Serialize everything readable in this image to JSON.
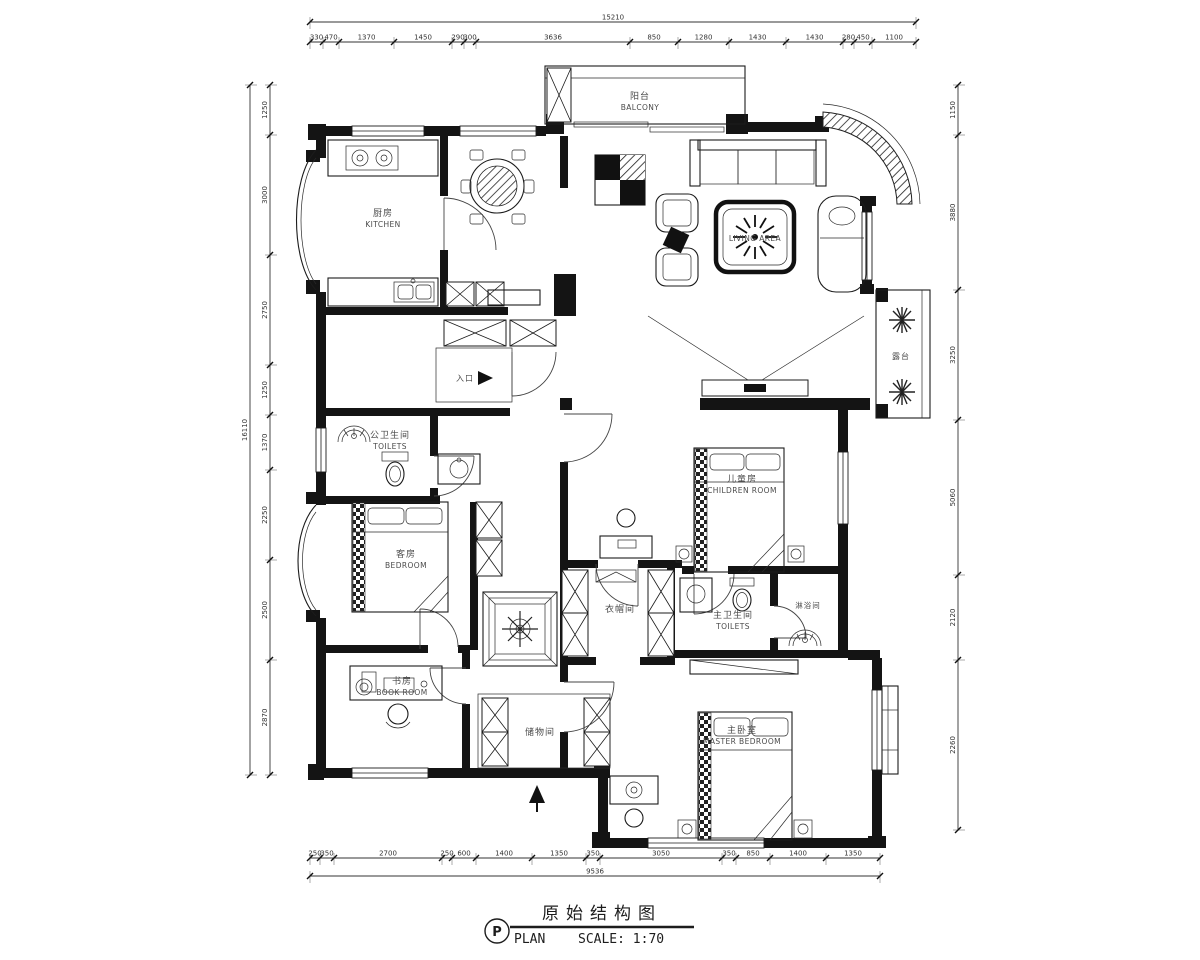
{
  "title_block": {
    "symbol": "P",
    "drawing_title": "原始结构图",
    "plan_label": "PLAN",
    "scale_label": "SCALE: 1:70"
  },
  "rooms": {
    "kitchen": {
      "cn": "厨房",
      "en": "KITCHEN"
    },
    "balcony": {
      "cn": "阳台",
      "en": "BALCONY"
    },
    "living": {
      "en": "LIVING AREA"
    },
    "children": {
      "cn": "儿童房",
      "en": "CHILDREN ROOM"
    },
    "guest": {
      "cn": "客房",
      "en": "BEDROOM"
    },
    "master": {
      "cn": "主卧室",
      "en": "MASTER BEDROOM"
    },
    "public_toilet": {
      "cn": "公卫生间",
      "en": "TOILETS"
    },
    "master_toilet": {
      "cn": "主卫生间",
      "en": "TOILETS"
    },
    "shower": {
      "cn": "淋浴间"
    },
    "closet": {
      "cn": "衣帽间"
    },
    "storage": {
      "cn": "储物间"
    },
    "study": {
      "cn": "书房",
      "en": "BOOK ROOM"
    },
    "entry": {
      "cn": "入口"
    },
    "terrace": {
      "cn": "露台"
    }
  },
  "dimensions": {
    "top": {
      "total": "15210",
      "segments": [
        "330",
        "470",
        "1370",
        "1450",
        "290",
        "300",
        "3636",
        "850",
        "1280",
        "1430",
        "1430",
        "280",
        "450",
        "1100"
      ]
    },
    "bottom": {
      "total": "9536",
      "segments": [
        "250",
        "350",
        "2700",
        "250",
        "600",
        "1400",
        "1350",
        "350",
        "3050",
        "350",
        "850",
        "1400",
        "1350"
      ]
    },
    "left": {
      "total": "16110",
      "segments": [
        "1250",
        "3000",
        "2750",
        "1250",
        "1370",
        "2250",
        "2500",
        "2870"
      ]
    },
    "right": {
      "segments": [
        "1150",
        "3880",
        "3250",
        "5060",
        "2120",
        "2260"
      ]
    }
  },
  "colors": {
    "line": "#1a1a1a",
    "text": "#4a4a4a",
    "background": "#ffffff"
  }
}
